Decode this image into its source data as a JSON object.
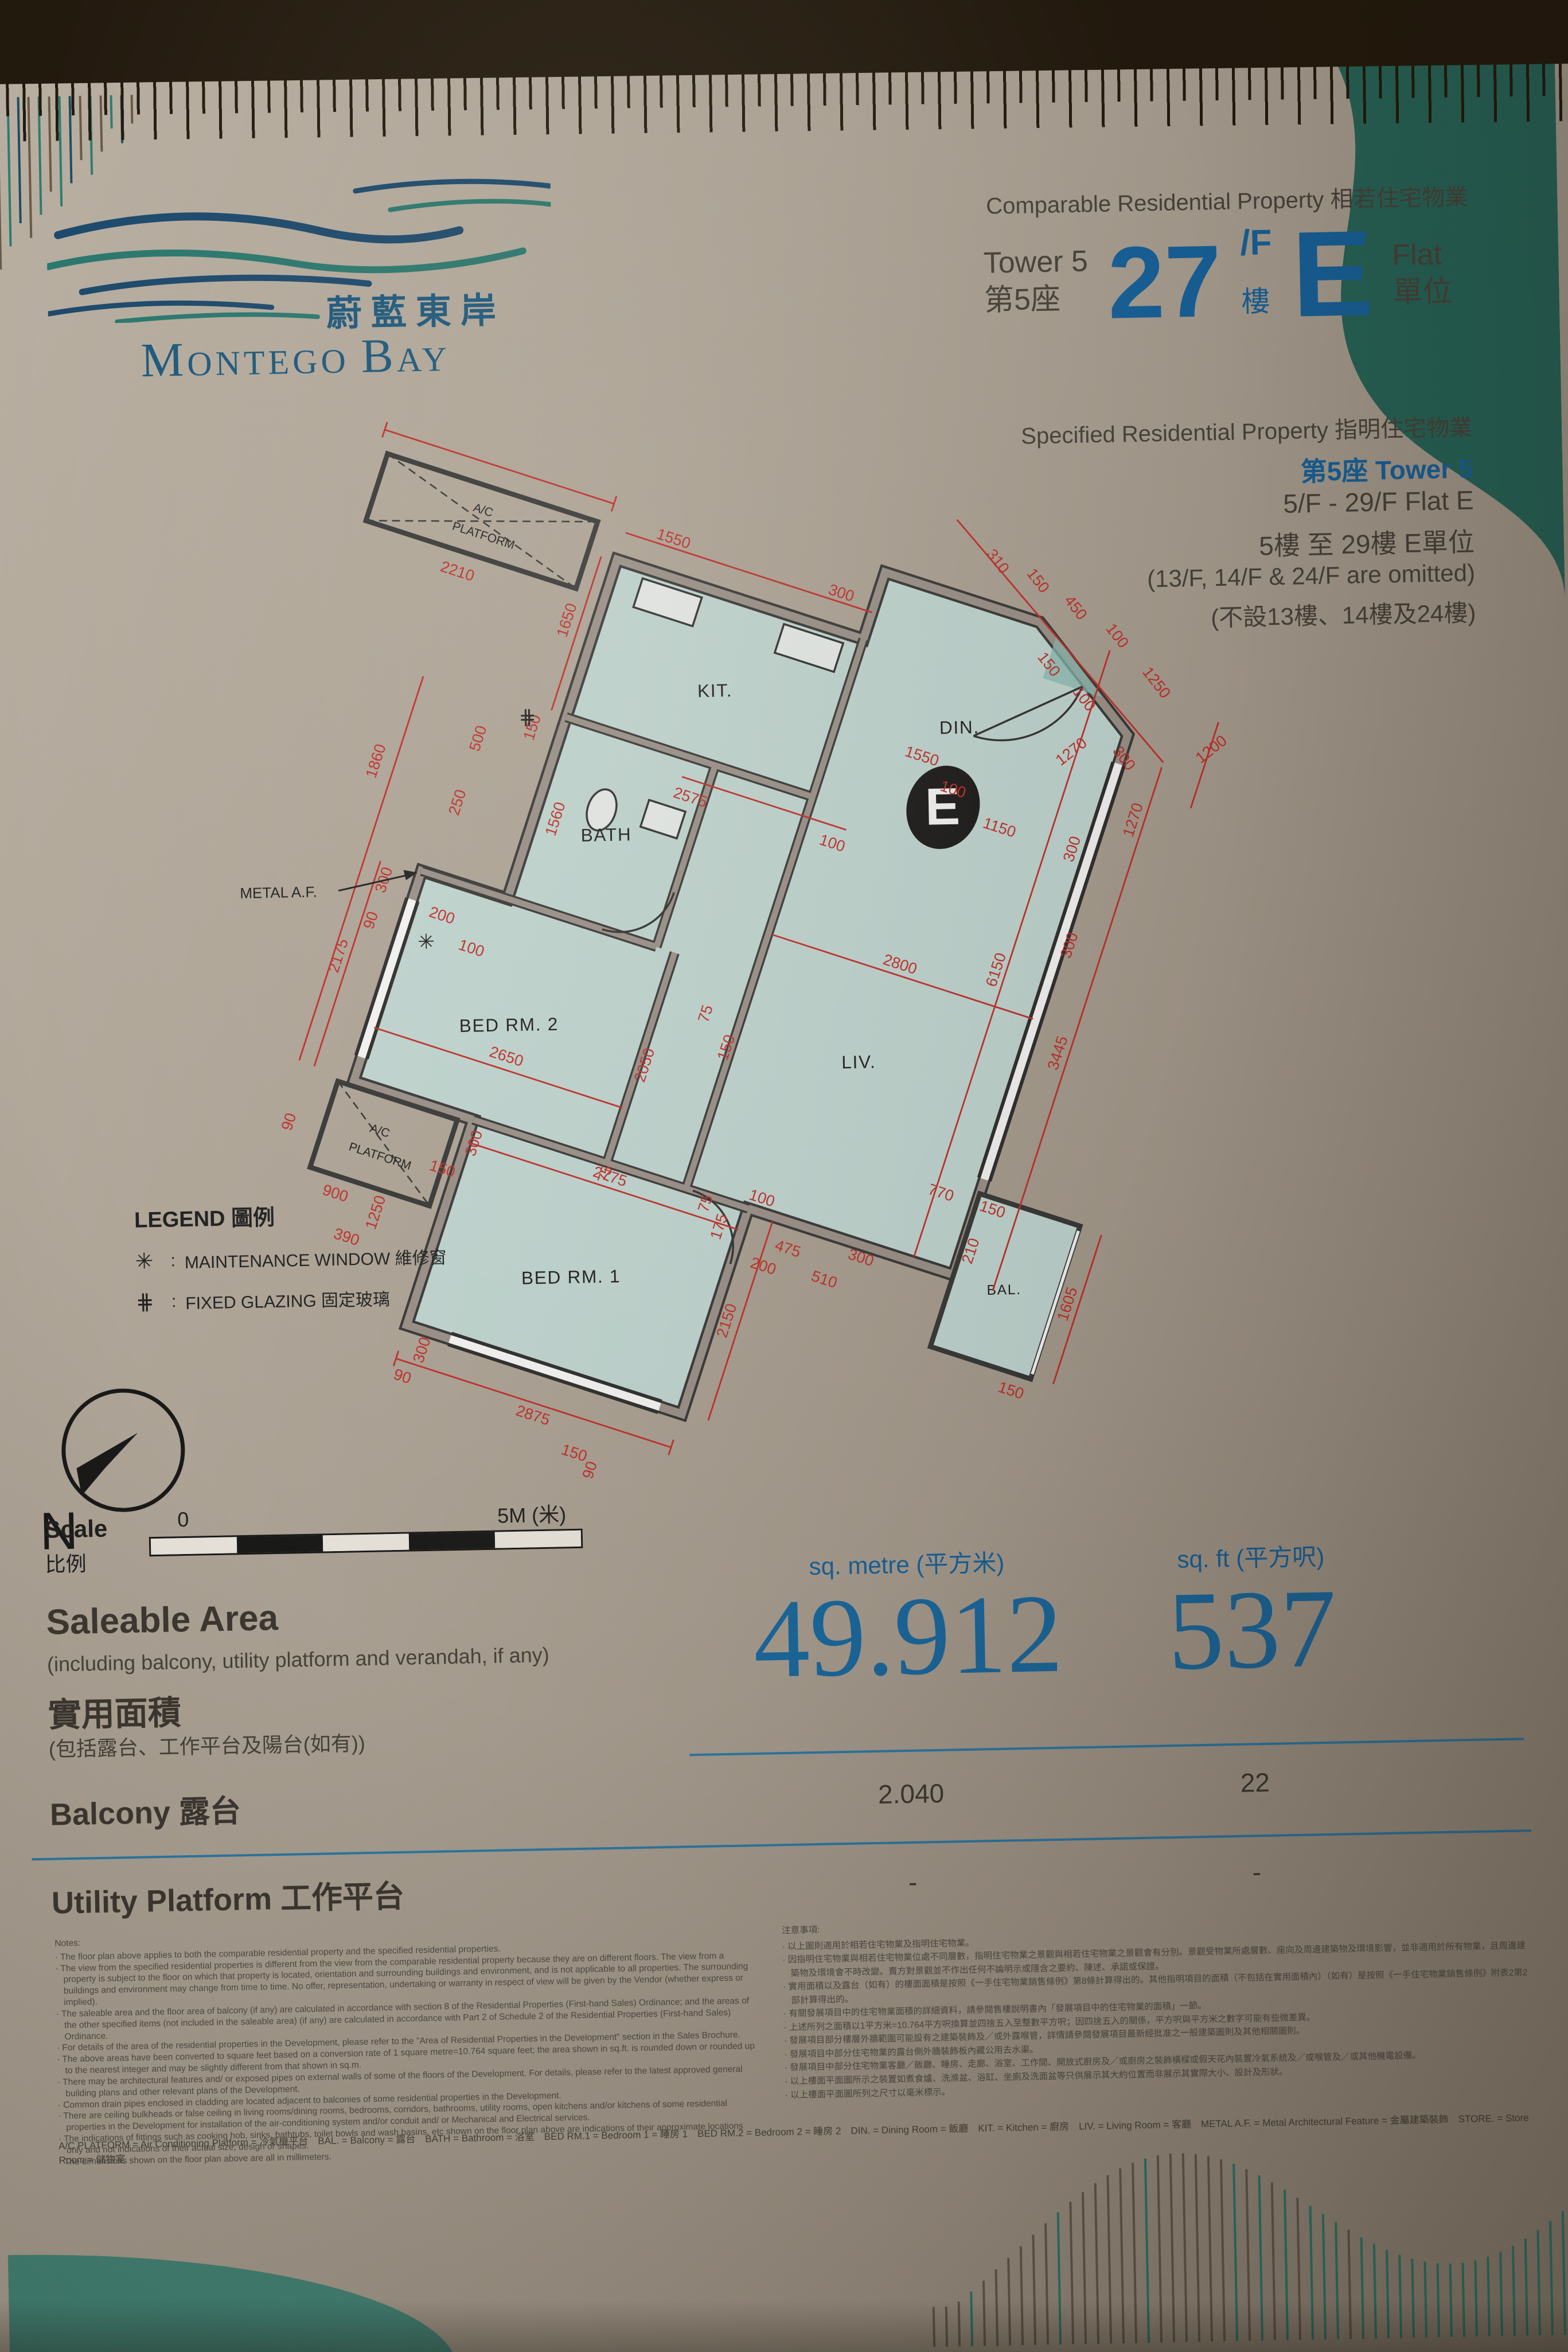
{
  "palette": {
    "accent_blue": "#1766a3",
    "dim_red": "#c9302b",
    "teal_deco": "#2a7265",
    "room_fill": "#c8ded9",
    "wall_gray": "#a0968e"
  },
  "brand": {
    "chinese_name": "蔚藍東岸",
    "english_first_m": "M",
    "english_rest1": "ONTEGO ",
    "english_first_b": "B",
    "english_rest2": "AY"
  },
  "header": {
    "comparable_label": "Comparable Residential Property 相若住宅物業",
    "tower_en": "Tower 5",
    "tower_zh": "第5座",
    "floor_number": "27",
    "floor_suffix": "/F",
    "floor_suffix_zh": "樓",
    "flat_letter": "E",
    "flat_en": "Flat",
    "flat_zh": "單位",
    "specified_label": "Specified Residential Property 指明住宅物業",
    "specified_tower": "第5座 Tower 5",
    "floor_range_en": "5/F  -  29/F   Flat E",
    "floor_range_zh": "5樓 至 29樓  E單位",
    "omitted_en": "(13/F, 14/F & 24/F are omitted)",
    "omitted_zh": "(不設13樓、14樓及24樓)"
  },
  "plan": {
    "rooms": {
      "kit": "KIT.",
      "din": "DIN.",
      "liv": "LIV.",
      "bath": "BATH",
      "bed2": "BED RM. 2",
      "bed1": "BED RM. 1",
      "bal": "BAL.",
      "ac1": "A/C",
      "ac2": "PLATFORM",
      "badge": "E",
      "metal_af": "METAL A.F.",
      "maint_symbol": "✳",
      "glaze_symbol": "⋕"
    },
    "dims": [
      "2210",
      "1550",
      "300",
      "1650",
      "150",
      "2575",
      "100",
      "500",
      "250",
      "1860",
      "1560",
      "310",
      "150",
      "450",
      "100",
      "1250",
      "150",
      "100",
      "1270",
      "300",
      "1550",
      "1150",
      "100",
      "300",
      "1270",
      "1200",
      "300",
      "3445",
      "6150",
      "2800",
      "770",
      "150",
      "210",
      "1605",
      "150",
      "300",
      "475",
      "510",
      "200",
      "2150",
      "175",
      "75",
      "100",
      "2775",
      "300",
      "150",
      "2875",
      "300",
      "90",
      "150",
      "90",
      "2650",
      "2050",
      "2175",
      "300",
      "90",
      "200",
      "100",
      "900",
      "90",
      "1250",
      "390",
      "75",
      "150",
      "75"
    ]
  },
  "legend": {
    "title": "LEGEND 圖例",
    "maint_symbol": "✳",
    "maint_label": "MAINTENANCE WINDOW 維修窗",
    "glaze_symbol": "⋕",
    "glaze_label": "FIXED GLAZING 固定玻璃",
    "colon": ":"
  },
  "compass": {
    "north": "N"
  },
  "scale": {
    "label_en": "Scale",
    "label_zh": "比例",
    "zero": "0",
    "max": "5M (米)"
  },
  "area": {
    "title_en": "Saleable Area",
    "subtitle_en": "(including balcony, utility platform and verandah, if any)",
    "title_zh": "實用面積",
    "subtitle_zh": "(包括露台、工作平台及陽台(如有))",
    "col_metre": "sq. metre (平方米)",
    "col_ft": "sq. ft (平方呎)",
    "saleable_sqm": "49.912",
    "saleable_sqft": "537",
    "balcony_label": "Balcony 露台",
    "balcony_sqm": "2.040",
    "balcony_sqft": "22",
    "utility_label": "Utility Platform 工作平台",
    "utility_sqm": "-",
    "utility_sqft": "-"
  },
  "notes": {
    "title_en": "Notes:",
    "en": [
      "The floor plan above applies to both the comparable residential property and the specified residential properties.",
      "The view from the specified residential properties is different from the view from the comparable residential property because they are on different floors. The view from a property is subject to the floor on which that property is located, orientation and surrounding buildings and environment, and is not applicable to all properties. The surrounding buildings and environment may change from time to time. No offer, representation, undertaking or warranty in respect of view will be given by the Vendor (whether express or implied).",
      "The saleable area and the floor area of balcony (if any) are calculated in accordance with section 8 of the Residential Properties (First-hand Sales) Ordinance; and the areas of the other specified items (not included in the saleable area) (if any) are calculated in accordance with Part 2 of Schedule 2 of the Residential Properties (First-hand Sales) Ordinance.",
      "For details of the area of the residential properties in the Development, please refer to the \"Area of Residential Properties in the Development\" section in the Sales Brochure.",
      "The above areas have been converted to square feet based on a conversion rate of 1 square metre=10.764 square feet; the area shown in sq.ft. is rounded down or rounded up to the nearest integer and may be slightly different from that shown in sq.m.",
      "There may be architectural features and/ or exposed pipes on external walls of some of the floors of the Development. For details, please refer to the latest approved general building plans and other relevant plans of the Development.",
      "Common drain pipes enclosed in cladding are located adjacent to balconies of some residential properties in the Development.",
      "There are ceiling bulkheads or false ceiling in living rooms/dining rooms, bedrooms, corridors, bathrooms, utility rooms, open kitchens and/or kitchens of some residential properties in the Development for installation of the air-conditioning system and/or conduit and/ or Mechanical and Electrical services.",
      "The indications of fittings such as cooking hob, sinks, bathtubs, toilet bowls and wash basins, etc shown on the floor plan above are indications of their approximate locations only and not indications of their actual size, design or shapes.",
      "The dimensions shown on the floor plan above are all in millimeters."
    ],
    "title_zh": "注意事項:",
    "zh": [
      "以上圖則適用於相若住宅物業及指明住宅物業。",
      "因指明住宅物業與相若住宅物業位處不同層數，指明住宅物業之景觀與相若住宅物業之景觀會有分別。景觀受物業所處層數、座向及周邊建築物及環境影響，並非適用於所有物業，且周邊建築物及環境會不時改變。賣方對景觀並不作出任何不論明示或隱含之要約、陳述、承諾或保證。",
      "實用面積以及露台（如有）的樓面面積是按照《一手住宅物業銷售條例》第8條計算得出的。其他指明項目的面積（不包括在實用面積內）（如有）是按照《一手住宅物業銷售條例》附表2第2部計算得出的。",
      "有關發展項目中的住宅物業面積的詳細資料，請參閱售樓說明書內「發展項目中的住宅物業的面積」一節。",
      "上述所列之面積以1平方米=10.764平方呎換算並四捨五入至整數平方呎；因四捨五入的關係，平方呎與平方米之數字可能有些微差異。",
      "發展項目部分樓層外牆範圍可能設有之建築裝飾及／或外露喉管，詳情請參閱發展項目最新經批准之一般建築圖則及其他相關圖則。",
      "發展項目中部分住宅物業的露台側外牆裝飾板內藏公用去水渠。",
      "發展項目中部分住宅物業客廳／飯廳、睡房、走廊、浴室、工作間、開放式廚房及／或廚房之裝飾橫樑或假天花內裝置冷氣系統及／或喉管及／或其他機電設備。",
      "以上樓面平面圖所示之裝置如煮食爐、洗滌盆、浴缸、坐廁及洗面盆等只供展示其大約位置而非展示其實際大小、設計及形狀。",
      "以上樓面平面圖所列之尺寸以毫米標示。"
    ]
  },
  "abbreviations": "A/C PLATFORM = Air Conditioning Platform = 冷氣機平台　BAL. = Balcony = 露台　BATH = Bathroom = 浴室　BED RM.1 = Bedroom 1 = 睡房 1　BED RM.2 = Bedroom 2 = 睡房 2　DIN. = Dining Room = 飯廳　KIT. = Kitchen = 廚房　LIV. = Living Room = 客廳　METAL A.F. = Metal Architectural Feature = 金屬建築裝飾　STORE. = Store Room = 儲物室"
}
